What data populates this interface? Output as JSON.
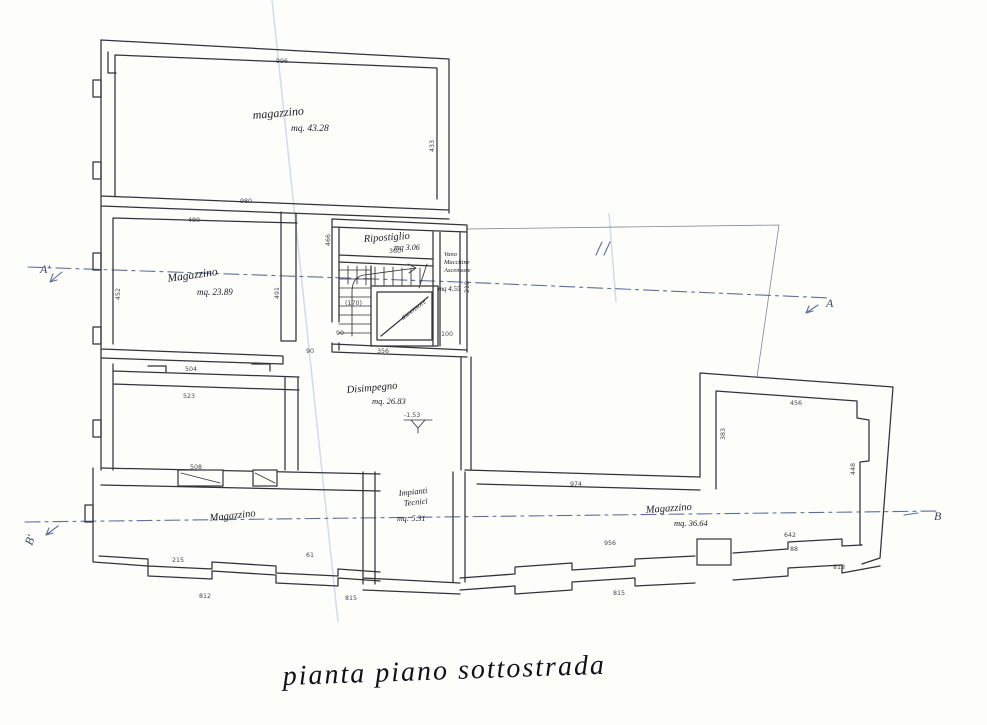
{
  "title": "pianta piano sottostrada",
  "sections": {
    "a_left": "A'",
    "a_right": "A",
    "b_left": "B'",
    "b_right": "B"
  },
  "rooms": {
    "top": {
      "name": "magazzino",
      "area": "mq. 43.28"
    },
    "left": {
      "name": "Magazzino",
      "area": "mq. 23.89"
    },
    "ripostiglio": {
      "name": "Ripostiglio",
      "area": "mq 3.06"
    },
    "vano": {
      "line1": "Vano",
      "line2": "Macchine",
      "line3": "Ascensore",
      "area": "mq 4.55"
    },
    "disimpegno": {
      "name": "Disimpegno",
      "area": "mq. 26.83"
    },
    "magazzino_sx": {
      "name": "Magazzino"
    },
    "impianti": {
      "line1": "Impianti",
      "line2": "Tecnici",
      "area": "mq: 5.31"
    },
    "magazzino_dx": {
      "name": "Magazzino",
      "area": "mq. 36.64"
    },
    "elevator": {
      "name": "ascensore"
    }
  },
  "annotations": {
    "level": "-1.53",
    "stair_run": "(170)"
  },
  "dims": [
    "996",
    "433",
    "980",
    "480",
    "452",
    "491",
    "90",
    "504",
    "523",
    "508",
    "360",
    "356",
    "100",
    "974",
    "956",
    "642",
    "456",
    "383",
    "448",
    "215",
    "61",
    "812",
    "815",
    "815",
    "818",
    "88",
    "466",
    "218",
    "90"
  ]
}
